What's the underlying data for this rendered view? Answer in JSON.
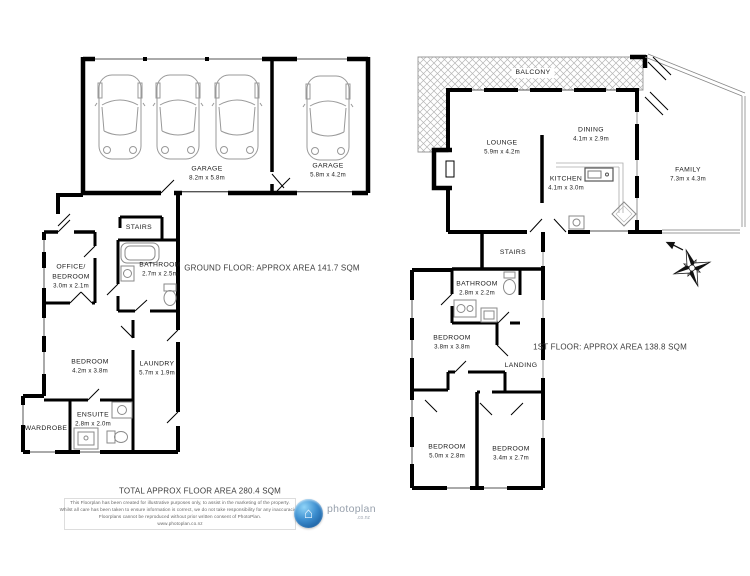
{
  "title": "Floorplan",
  "ground_floor": {
    "area_label": "GROUND FLOOR: APPROX AREA 141.7 SQM",
    "rooms": [
      {
        "name": "GARAGE",
        "dims": "8.2m x 5.8m"
      },
      {
        "name": "GARAGE",
        "dims": "5.8m x 4.2m"
      },
      {
        "name": "STAIRS",
        "dims": ""
      },
      {
        "name": "BATHROOM",
        "dims": "2.7m x 2.5m"
      },
      {
        "name": "OFFICE/",
        "name2": "BEDROOM",
        "dims": "3.0m x 2.1m"
      },
      {
        "name": "BEDROOM",
        "dims": "4.2m x 3.8m"
      },
      {
        "name": "LAUNDRY",
        "dims": "5.7m x 1.9m"
      },
      {
        "name": "WARDROBE",
        "dims": ""
      },
      {
        "name": "ENSUITE",
        "dims": "2.8m x 2.0m"
      }
    ]
  },
  "first_floor": {
    "area_label": "1ST FLOOR: APPROX AREA 138.8 SQM",
    "rooms": [
      {
        "name": "BALCONY",
        "dims": ""
      },
      {
        "name": "LOUNGE",
        "dims": "5.9m x 4.2m"
      },
      {
        "name": "DINING",
        "dims": "4.1m x 2.9m"
      },
      {
        "name": "KITCHEN",
        "dims": "4.1m x 3.0m"
      },
      {
        "name": "FAMILY",
        "dims": "7.3m x 4.3m"
      },
      {
        "name": "STAIRS",
        "dims": ""
      },
      {
        "name": "BATHROOM",
        "dims": "2.8m x 2.2m"
      },
      {
        "name": "BEDROOM",
        "dims": "3.8m x 3.8m"
      },
      {
        "name": "LANDING",
        "dims": ""
      },
      {
        "name": "BEDROOM",
        "dims": "5.0m x 2.8m"
      },
      {
        "name": "BEDROOM",
        "dims": "3.4m x 2.7m"
      }
    ]
  },
  "footer": {
    "total_area": "TOTAL APPROX FLOOR AREA 280.4 SQM",
    "disclaimer_lines": [
      "This Floorplan has been created for illustrative purposes only, to assist in the marketing of the property.",
      "Whilst all care has been taken to ensure information is correct, we do not take responsibility for any inaccuracies.",
      "Floorplans cannot be reproduced without prior written consent of PhotoPlan.",
      "www.photoplan.co.nz"
    ],
    "logo": {
      "brand": "photoplan",
      "tld": ".co.nz",
      "house_icon": "⌂"
    }
  },
  "colors": {
    "wall": "#000000",
    "fixture": "#8a8a8a",
    "hatch": "#b5b5b5",
    "logo_blue": "#2d7dc1"
  }
}
